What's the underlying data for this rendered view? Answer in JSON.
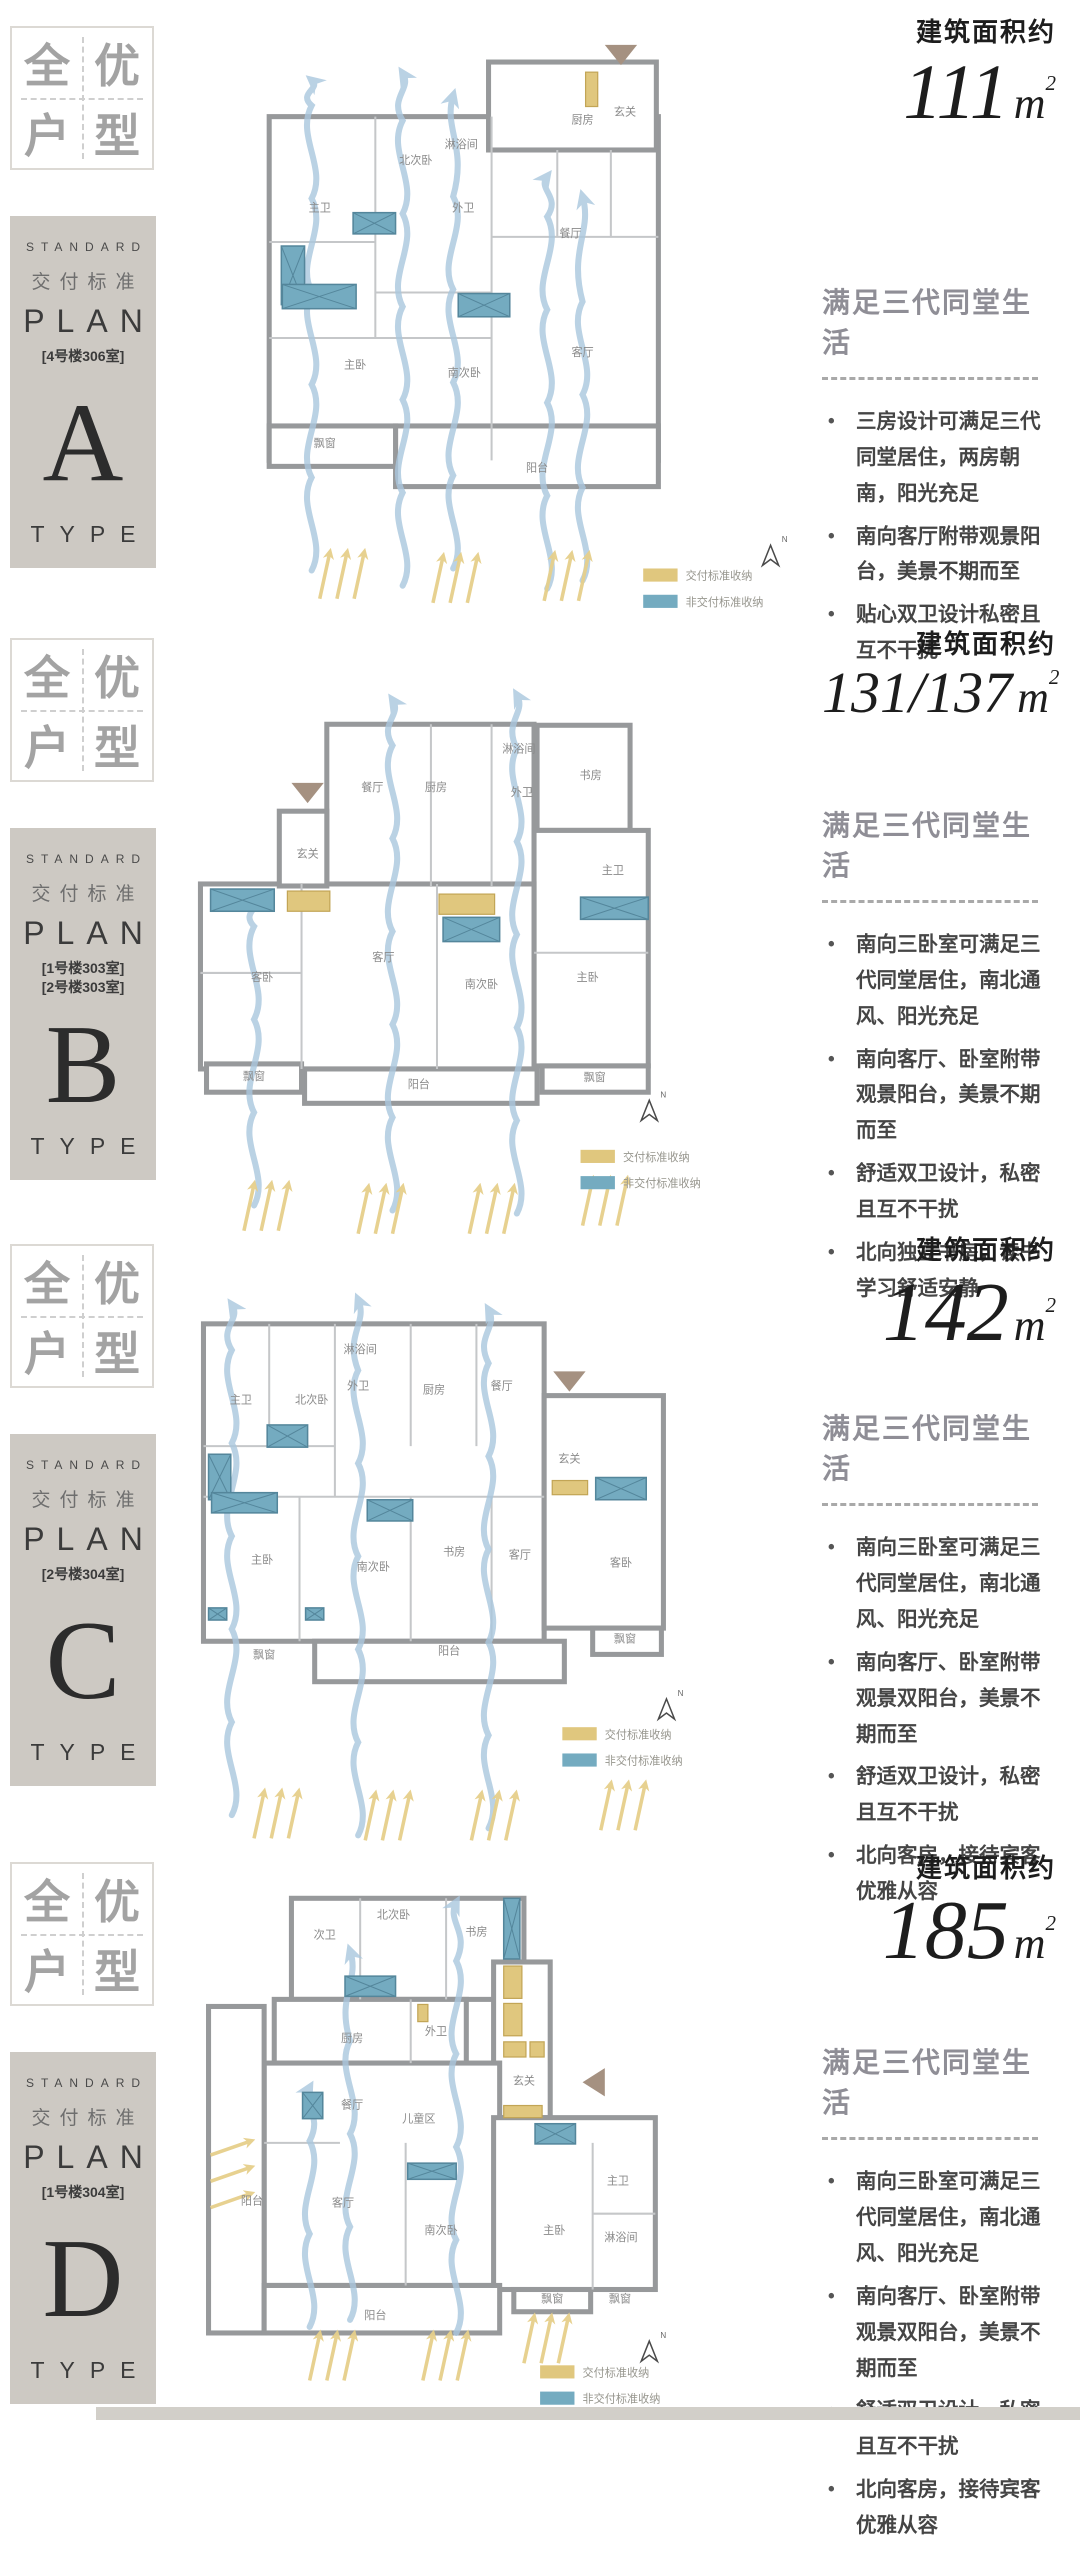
{
  "common": {
    "area_label": "建筑面积约",
    "headline": "满足三代同堂生活",
    "unit_m": "m",
    "unit_sup": "2"
  },
  "badge": {
    "chars": [
      "全",
      "优",
      "户",
      "型"
    ]
  },
  "plan_block": {
    "standard": "STANDARD",
    "delivery": "交付标准",
    "plan": "PLAN",
    "type": "TYPE"
  },
  "legend": {
    "delivered": "交付标准收纳",
    "not_delivered": "非交付标准收纳",
    "north": "N"
  },
  "colors": {
    "wall": "#97999b",
    "inner": "#c5c7c9",
    "teal": "#74abc0",
    "teal_dark": "#54869b",
    "yellow": "#e0c77e",
    "yellow_dark": "#c2a556",
    "flow": "#aac7de",
    "sun": "#e6cf8b",
    "taupe": "#a59181",
    "block_bg": "#cdc9c3",
    "room_text": "#8a8a8a",
    "legend_text": "#97968e"
  },
  "sections": [
    {
      "letter": "A",
      "rooms": [
        "[4号楼306室]"
      ],
      "area_value": "111",
      "bullets": [
        "三房设计可满足三代同堂居住，两房朝南，阳光充足",
        "南向客厅附带观景阳台，美景不期而至",
        "贴心双卫设计私密且互不干扰"
      ],
      "plan": {
        "rects": [
          [
            110,
            81,
            385,
            340
          ],
          [
            327,
            27,
            166,
            87
          ],
          [
            235,
            387,
            260,
            60
          ],
          [
            110,
            387,
            125,
            40
          ]
        ],
        "lines": [
          [
            215,
            81,
            215,
            300
          ],
          [
            330,
            81,
            330,
            421
          ],
          [
            110,
            205,
            215,
            205
          ],
          [
            110,
            300,
            330,
            300
          ],
          [
            448,
            114,
            448,
            200
          ],
          [
            395,
            114,
            395,
            200
          ],
          [
            330,
            200,
            495,
            200
          ],
          [
            215,
            255,
            330,
            255
          ]
        ],
        "teal": [
          [
            193,
            176,
            42,
            21
          ],
          [
            122,
            209,
            23,
            58
          ],
          [
            123,
            247,
            73,
            24
          ],
          [
            297,
            256,
            51,
            23
          ]
        ],
        "yellow": [
          [
            423,
            37,
            12,
            34
          ]
        ],
        "flows": [
          [
            152,
            530,
            45
          ],
          [
            242,
            545,
            38
          ],
          [
            292,
            528,
            60
          ],
          [
            385,
            548,
            140
          ],
          [
            420,
            540,
            160
          ]
        ],
        "suns": [
          [
            160,
            558,
            3,
            17,
            0,
            10,
            -46
          ],
          [
            272,
            562,
            3,
            17,
            0,
            10,
            -46
          ],
          [
            382,
            560,
            3,
            17,
            0,
            10,
            -46
          ]
        ],
        "rooms": [
          [
            "主卫",
            160,
            175
          ],
          [
            "北次卧",
            255,
            128
          ],
          [
            "淋浴间",
            300,
            112
          ],
          [
            "外卫",
            302,
            175
          ],
          [
            "厨房",
            420,
            88
          ],
          [
            "玄关",
            462,
            80
          ],
          [
            "餐厅",
            408,
            200
          ],
          [
            "主卧",
            195,
            330
          ],
          [
            "南次卧",
            303,
            338
          ],
          [
            "客厅",
            420,
            318
          ],
          [
            "阳台",
            375,
            432
          ],
          [
            "飘窗",
            165,
            408
          ]
        ],
        "tri": [
          458,
          10,
          "down"
        ],
        "north": [
          598,
          505
        ],
        "legend": [
          480,
          528
        ]
      }
    },
    {
      "letter": "B",
      "rooms": [
        "[1号楼303室]",
        "[2号楼303室]"
      ],
      "area_value": "131/137",
      "bullets": [
        "南向三卧室可满足三代同堂居住，南北通风、阳光充足",
        "南向客厅、卧室附带观景阳台，美景不期而至",
        "舒适双卫设计，私密且互不干扰",
        "北向独立书房，读书学习舒适安静"
      ],
      "plan": {
        "rects": [
          [
            167,
            64,
            205,
            160
          ],
          [
            375,
            65,
            92,
            104
          ],
          [
            372,
            169,
            113,
            233
          ],
          [
            42,
            222,
            330,
            183
          ],
          [
            145,
            405,
            230,
            34
          ],
          [
            48,
            400,
            94,
            28
          ],
          [
            380,
            402,
            105,
            26
          ],
          [
            120,
            150,
            47,
            74
          ]
        ],
        "lines": [
          [
            270,
            64,
            270,
            224
          ],
          [
            330,
            64,
            330,
            224
          ],
          [
            142,
            222,
            142,
            405
          ],
          [
            276,
            222,
            276,
            405
          ],
          [
            372,
            290,
            485,
            290
          ],
          [
            42,
            310,
            142,
            310
          ]
        ],
        "teal": [
          [
            52,
            227,
            63,
            22
          ],
          [
            282,
            255,
            56,
            24
          ],
          [
            418,
            235,
            67,
            22
          ]
        ],
        "yellow": [
          [
            128,
            229,
            42,
            20
          ],
          [
            278,
            232,
            55,
            20
          ]
        ],
        "flows": [
          [
            232,
            545,
            40
          ],
          [
            355,
            548,
            35
          ],
          [
            95,
            540,
            235
          ]
        ],
        "suns": [
          [
            85,
            565,
            3,
            17,
            0,
            10,
            -46
          ],
          [
            198,
            568,
            3,
            17,
            0,
            10,
            -46
          ],
          [
            308,
            568,
            3,
            17,
            0,
            10,
            -46
          ],
          [
            420,
            560,
            3,
            17,
            0,
            10,
            -46
          ]
        ],
        "rooms": [
          [
            "餐厅",
            212,
            130
          ],
          [
            "厨房",
            275,
            130
          ],
          [
            "淋浴间",
            357,
            92
          ],
          [
            "外卫",
            360,
            135
          ],
          [
            "书房",
            428,
            118
          ],
          [
            "玄关",
            148,
            196
          ],
          [
            "客卧",
            103,
            318
          ],
          [
            "客厅",
            223,
            298
          ],
          [
            "南次卧",
            320,
            325
          ],
          [
            "主卧",
            425,
            318
          ],
          [
            "主卫",
            450,
            212
          ],
          [
            "阳台",
            258,
            424
          ],
          [
            "飘窗",
            95,
            416
          ],
          [
            "飘窗",
            432,
            417
          ]
        ],
        "tri": [
          148,
          122,
          "down"
        ],
        "north": [
          478,
          436
        ],
        "legend": [
          418,
          485
        ]
      }
    },
    {
      "letter": "C",
      "rooms": [
        "[2号楼304室]"
      ],
      "area_value": "142",
      "bullets": [
        "南向三卧室可满足三代同堂居住，南北通风、阳光充足",
        "南向客厅、卧室附带观景双阳台，美景不期而至",
        "舒适双卫设计，私密且互不干扰",
        "北向客房，接待宾客优雅从容"
      ],
      "plan": {
        "rects": [
          [
            45,
            59,
            337,
            314
          ],
          [
            382,
            130,
            118,
            230
          ],
          [
            155,
            373,
            247,
            40
          ],
          [
            430,
            360,
            68,
            26
          ]
        ],
        "lines": [
          [
            110,
            59,
            110,
            180
          ],
          [
            175,
            59,
            175,
            230
          ],
          [
            250,
            59,
            250,
            180
          ],
          [
            315,
            59,
            315,
            180
          ],
          [
            45,
            180,
            175,
            180
          ],
          [
            140,
            230,
            140,
            373
          ],
          [
            250,
            230,
            250,
            373
          ],
          [
            45,
            230,
            382,
            230
          ],
          [
            330,
            230,
            330,
            373
          ]
        ],
        "teal": [
          [
            50,
            188,
            22,
            45
          ],
          [
            53,
            226,
            65,
            20
          ],
          [
            108,
            159,
            40,
            22
          ],
          [
            207,
            233,
            45,
            21
          ],
          [
            433,
            211,
            50,
            22
          ],
          [
            50,
            340,
            18,
            12
          ],
          [
            146,
            340,
            18,
            12
          ]
        ],
        "yellow": [
          [
            390,
            214,
            35,
            14
          ]
        ],
        "flows": [
          [
            73,
            545,
            40
          ],
          [
            198,
            565,
            35
          ],
          [
            327,
            558,
            45
          ]
        ],
        "suns": [
          [
            95,
            568,
            3,
            17,
            0,
            10,
            -46
          ],
          [
            205,
            570,
            3,
            17,
            0,
            10,
            -46
          ],
          [
            310,
            570,
            3,
            17,
            0,
            10,
            -46
          ],
          [
            438,
            560,
            3,
            17,
            0,
            10,
            -46
          ]
        ],
        "rooms": [
          [
            "主卫",
            82,
            138
          ],
          [
            "北次卧",
            152,
            138
          ],
          [
            "淋浴间",
            200,
            88
          ],
          [
            "外卫",
            198,
            124
          ],
          [
            "厨房",
            273,
            128
          ],
          [
            "餐厅",
            340,
            124
          ],
          [
            "玄关",
            407,
            196
          ],
          [
            "主卧",
            103,
            296
          ],
          [
            "南次卧",
            213,
            303
          ],
          [
            "书房",
            293,
            288
          ],
          [
            "客厅",
            358,
            291
          ],
          [
            "客卧",
            458,
            299
          ],
          [
            "阳台",
            288,
            386
          ],
          [
            "飘窗",
            105,
            390
          ],
          [
            "飘窗",
            462,
            374
          ]
        ],
        "tri": [
          407,
          106,
          "down"
        ],
        "north": [
          495,
          430
        ],
        "legend": [
          400,
          458
        ]
      }
    },
    {
      "letter": "D",
      "rooms": [
        "[1号楼304室]"
      ],
      "area_value": "185",
      "bullets": [
        "南向三卧室可满足三代同堂居住，南北通风、阳光充足",
        "南向客厅、卧室附带观景双阳台，美景不期而至",
        "舒适双卫设计，私密且互不干扰",
        "北向客房，接待宾客优雅从容"
      ],
      "plan": {
        "rects": [
          [
            132,
            8,
            230,
            100
          ],
          [
            115,
            108,
            190,
            63
          ],
          [
            332,
            71,
            56,
            154
          ],
          [
            105,
            171,
            233,
            220
          ],
          [
            332,
            225,
            160,
            170
          ],
          [
            50,
            115,
            55,
            323
          ],
          [
            105,
            391,
            233,
            47
          ],
          [
            352,
            395,
            76,
            22
          ]
        ],
        "lines": [
          [
            200,
            8,
            200,
            108
          ],
          [
            285,
            8,
            285,
            108
          ],
          [
            250,
            108,
            250,
            171
          ],
          [
            245,
            250,
            245,
            391
          ],
          [
            430,
            250,
            430,
            395
          ],
          [
            430,
            320,
            492,
            320
          ],
          [
            105,
            250,
            180,
            250
          ]
        ],
        "teal": [
          [
            185,
            85,
            50,
            20
          ],
          [
            342,
            8,
            16,
            60
          ],
          [
            373,
            231,
            40,
            20
          ],
          [
            247,
            270,
            48,
            16
          ],
          [
            143,
            200,
            20,
            26
          ]
        ],
        "yellow": [
          [
            342,
            75,
            18,
            32
          ],
          [
            342,
            112,
            18,
            32
          ],
          [
            342,
            150,
            22,
            15
          ],
          [
            368,
            150,
            14,
            15
          ],
          [
            342,
            213,
            38,
            12
          ],
          [
            257,
            113,
            10,
            17
          ]
        ],
        "flows": [
          [
            190,
            425,
            60
          ],
          [
            295,
            438,
            12
          ],
          [
            150,
            432,
            195
          ]
        ],
        "suns": [
          [
            52,
            262,
            3,
            0,
            26,
            40,
            -14
          ],
          [
            150,
            485,
            3,
            17,
            0,
            10,
            -46
          ],
          [
            262,
            485,
            3,
            17,
            0,
            10,
            -46
          ],
          [
            362,
            468,
            3,
            17,
            0,
            10,
            -46
          ]
        ],
        "rooms": [
          [
            "次卫",
            165,
            48
          ],
          [
            "北次卧",
            233,
            28
          ],
          [
            "书房",
            315,
            45
          ],
          [
            "厨房",
            192,
            150
          ],
          [
            "外卫",
            275,
            143
          ],
          [
            "玄关",
            362,
            192
          ],
          [
            "餐厅",
            192,
            216
          ],
          [
            "儿童区",
            258,
            230
          ],
          [
            "客厅",
            183,
            313
          ],
          [
            "南次卧",
            280,
            340
          ],
          [
            "主卧",
            392,
            340
          ],
          [
            "主卫",
            455,
            291
          ],
          [
            "淋浴间",
            458,
            347
          ],
          [
            "阳台",
            93,
            311
          ],
          [
            "阳台",
            215,
            424
          ],
          [
            "飘窗",
            390,
            408
          ],
          [
            "飘窗",
            457,
            408
          ]
        ],
        "tri": [
          420,
          190,
          "left"
        ],
        "north": [
          478,
          446
        ],
        "legend": [
          378,
          470
        ]
      }
    }
  ]
}
